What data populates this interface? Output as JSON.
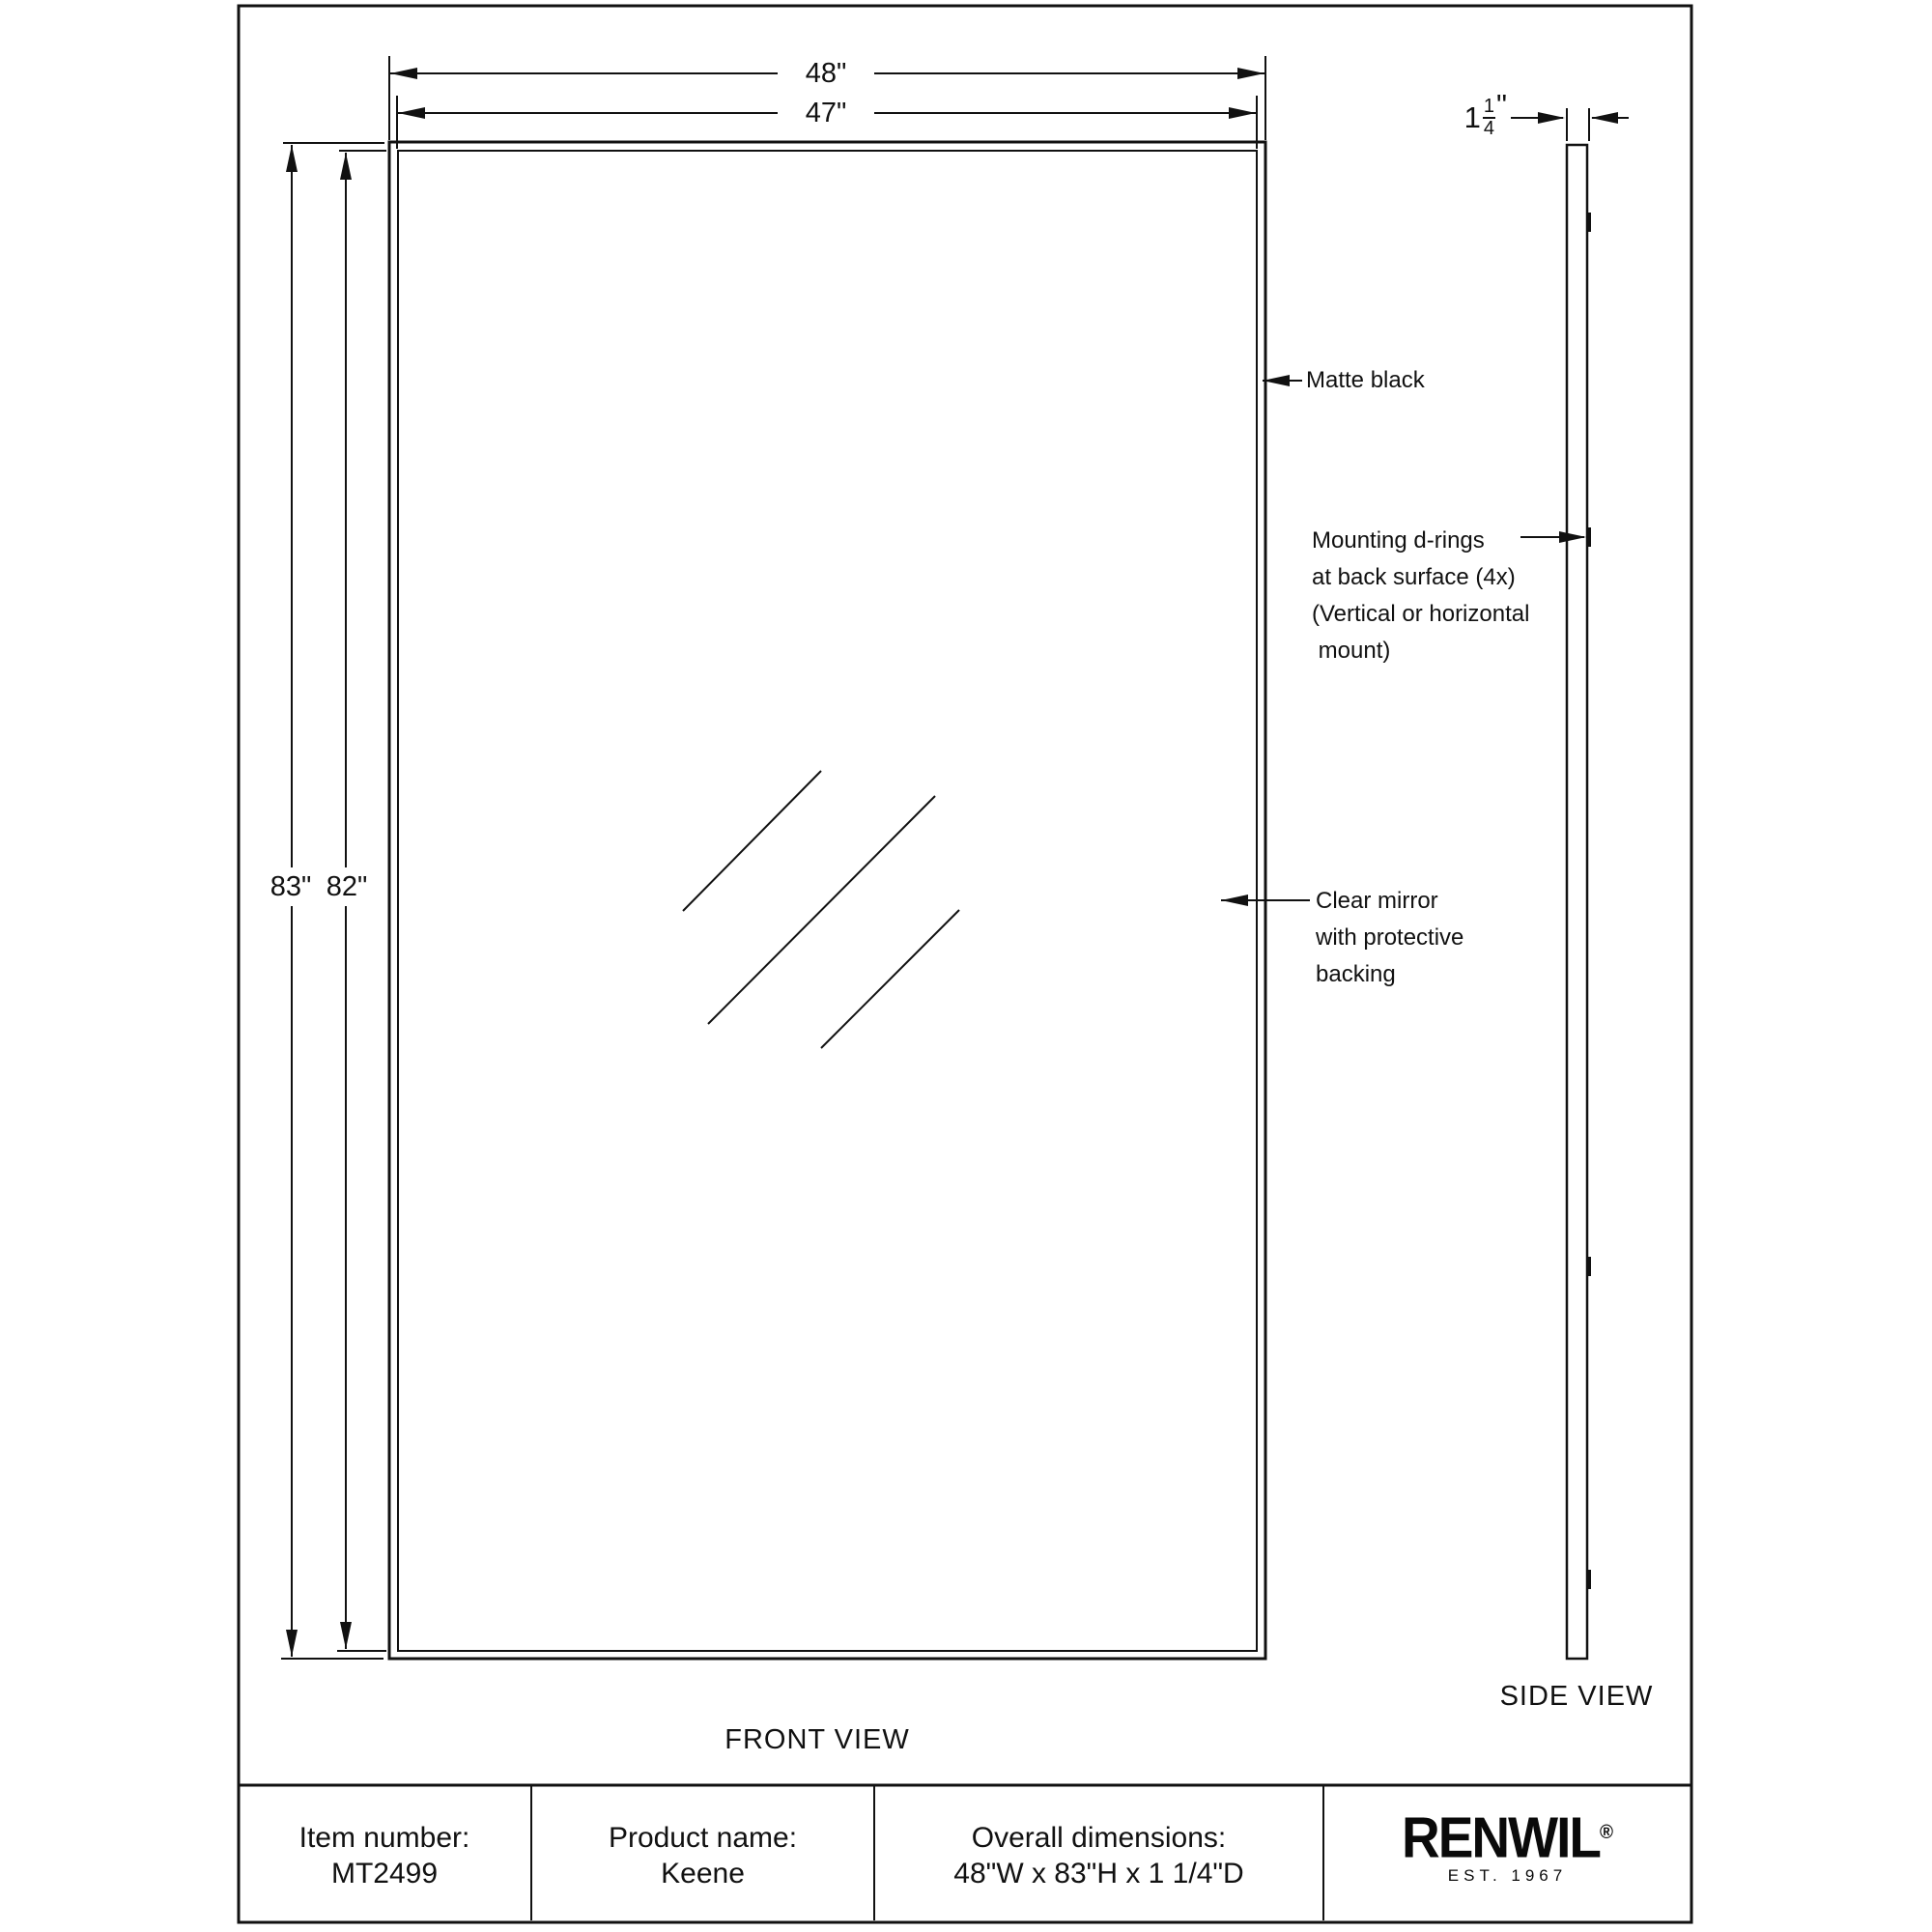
{
  "views": {
    "front_label": "FRONT VIEW",
    "side_label": "SIDE VIEW"
  },
  "dimensions": {
    "width_outer": "48\"",
    "width_inner": "47\"",
    "height_outer": "83\"",
    "height_inner": "82\"",
    "depth": {
      "whole": "1",
      "numerator": "1",
      "denominator": "4",
      "unit": "\""
    }
  },
  "annotations": {
    "frame_finish": "Matte black",
    "mounting": [
      "Mounting d-rings",
      "at back surface (4x)",
      "(Vertical or horizontal",
      " mount)"
    ],
    "mirror": [
      "Clear mirror",
      "with protective",
      "backing"
    ]
  },
  "title_block": {
    "item": {
      "label": "Item number:",
      "value": "MT2499"
    },
    "product": {
      "label": "Product name:",
      "value": "Keene"
    },
    "overall": {
      "label": "Overall dimensions:",
      "value": "48\"W x 83\"H x 1 1/4\"D"
    },
    "brand": {
      "name": "RENWIL",
      "registered": "®",
      "tagline": "EST. 1967"
    }
  },
  "colors": {
    "ink": "#111111",
    "paper": "#ffffff"
  }
}
